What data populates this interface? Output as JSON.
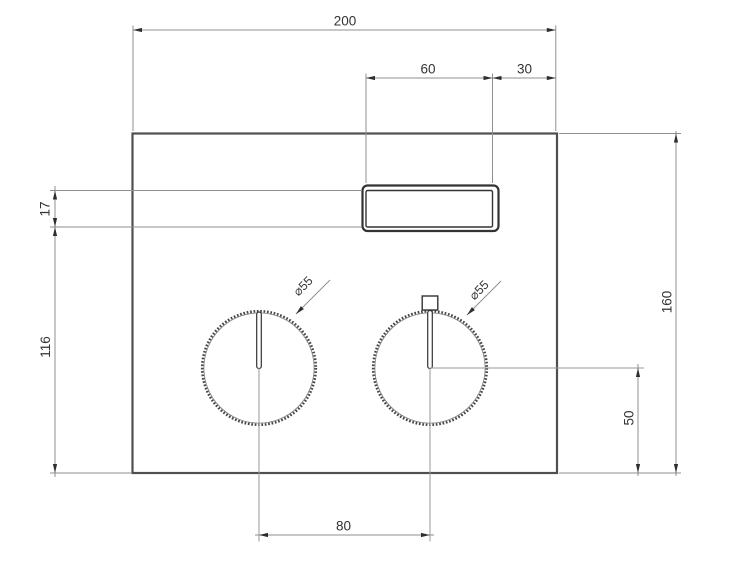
{
  "drawing": {
    "title": "Control panel dimension drawing",
    "units": "mm",
    "part": "rectangular front panel with display window and two knurled control knobs",
    "colors": {
      "background": "#ffffff",
      "part_outline": "#4f4f4f",
      "window_outline": "#333333",
      "dimension_lines": "#8f8f8f",
      "dimension_text": "#333333"
    }
  },
  "dims": {
    "overall_width": {
      "value": "200"
    },
    "window_width": {
      "value": "60"
    },
    "window_right_gap": {
      "value": "30"
    },
    "window_height": {
      "value": "17"
    },
    "window_to_bottom": {
      "value": "116"
    },
    "overall_height": {
      "value": "160"
    },
    "knob_axis_to_bottom": {
      "value": "50"
    },
    "knob_spacing": {
      "value": "80"
    },
    "left_knob_diameter": {
      "value": "⌀55"
    },
    "right_knob_diameter": {
      "value": "⌀55"
    }
  }
}
